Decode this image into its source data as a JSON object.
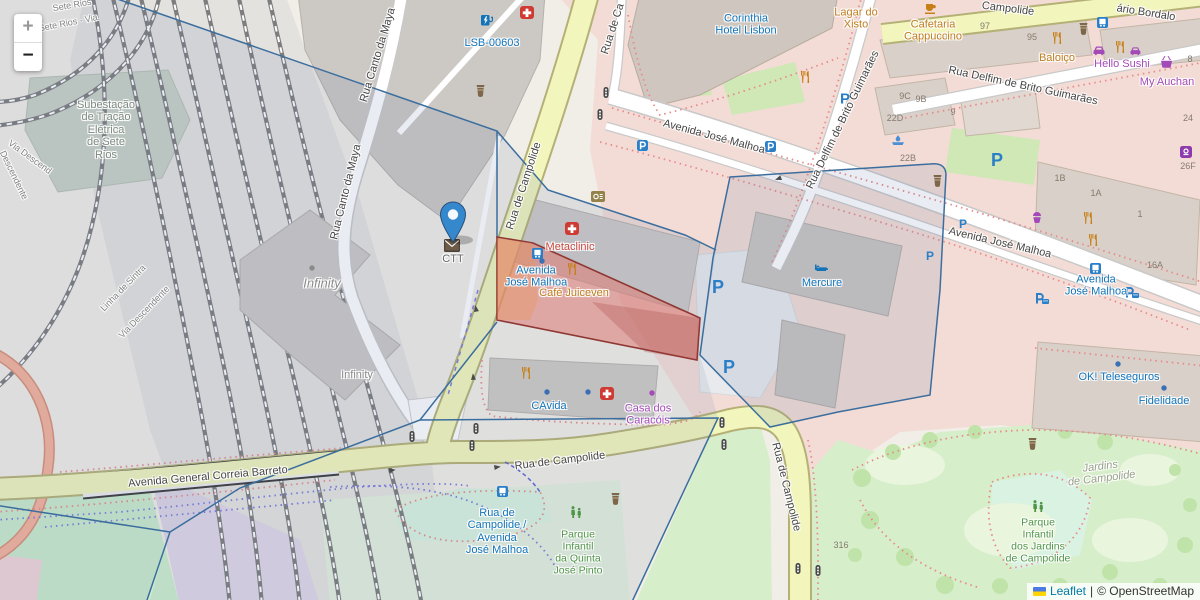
{
  "controls": {
    "zoom_in": "+",
    "zoom_out": "−"
  },
  "attribution": {
    "leaflet": "Leaflet",
    "sep": "|",
    "copyright": "© OpenStreetMap"
  },
  "streets": {
    "canto_da_maya_a": "Rua Canto da Maya",
    "canto_da_maya_b": "Rua Canto da Maya",
    "campolide_top": "Rua de Campolide",
    "campolide_top_partial": "Rua de Ca",
    "campolide_bottom": "Rua de Campolide",
    "campolide_south": "Rua de Campolide",
    "campolide_ne": "Campolide",
    "jose_malhoa_a": "Avenida José Malhoa",
    "jose_malhoa_b": "Avenida José Malhoa",
    "delfim_a": "Rua Delfim de Brito Guimarães",
    "delfim_b": "Rua Delfim de Brito Guimarães",
    "correia_barreto": "Avenida General Correia Barreto",
    "bordalo": "ário Bordalo"
  },
  "railways": {
    "sete_rios_a": "Sete Rios",
    "sete_rios_b": "de Sete Rios · Via",
    "descendente_left": "Descendente",
    "via_descend": "Via Descend",
    "linha_sintra": "Linha de Sintra",
    "via_descendente_b": "Via Descendente"
  },
  "areas": {
    "substation": "Subestação\nde Tração\nElétrica\nde Sete\nRios",
    "infinity_area": "Infinity",
    "infinity_building": "Infinity",
    "jardins": "Jardins\nde Campolide"
  },
  "pois": {
    "lsb": "LSB-00603",
    "corinthia": "Corinthia\nHotel Lisbon",
    "lagar": "Lagar do\nXisto",
    "cafetaria": "Cafetaria\nCappuccino",
    "baloico": "Baloiço",
    "hello_sushi": "Hello Sushi",
    "my_auchan": "My Auchan",
    "metaclinic": "Metaclinic",
    "stop_jose_malhoa_w": "Avenida\nJosé Malhoa",
    "cafe_juiceven": "Café Juiceven",
    "mercure": "Mercure",
    "ctt": "CTT",
    "cavida": "CAvida",
    "casa_caracois": "Casa dos\nCaracóis",
    "ok_teleseguros": "OK! Teleseguros",
    "fidelidade": "Fidelidade",
    "stop_jose_malhoa_e": "Avenida\nJosé Malhoa",
    "stop_campolide": "Rua de\nCampolide /\nAvenida\nJosé Malhoa",
    "parque_quinta": "Parque\nInfantil\nda Quinta\nJosé Pinto",
    "parque_jardins": "Parque\nInfantil\ndos Jardins\nde Campolide",
    "parking": "P"
  },
  "housenumbers": [
    "97",
    "95",
    "9C",
    "9B",
    "22D",
    "9",
    "22B",
    "8",
    "24",
    "1B",
    "1A",
    "1",
    "16A",
    "26F",
    "316"
  ],
  "colors": {
    "poi_blue": "#1273b8",
    "poi_orange": "#bf7d1e",
    "poi_purple": "#a44ab8",
    "poi_red": "#c7463d",
    "poi_green": "#4e9546",
    "street_text": "#454545",
    "selection_fill": "#e07a72",
    "selection_stroke": "#8f3732",
    "boundary_blue": "#3b6e9e",
    "marker_blue": "#3588cc",
    "road_yellow": "#f2f5bc",
    "residential_pink": "#f3dcd6"
  }
}
